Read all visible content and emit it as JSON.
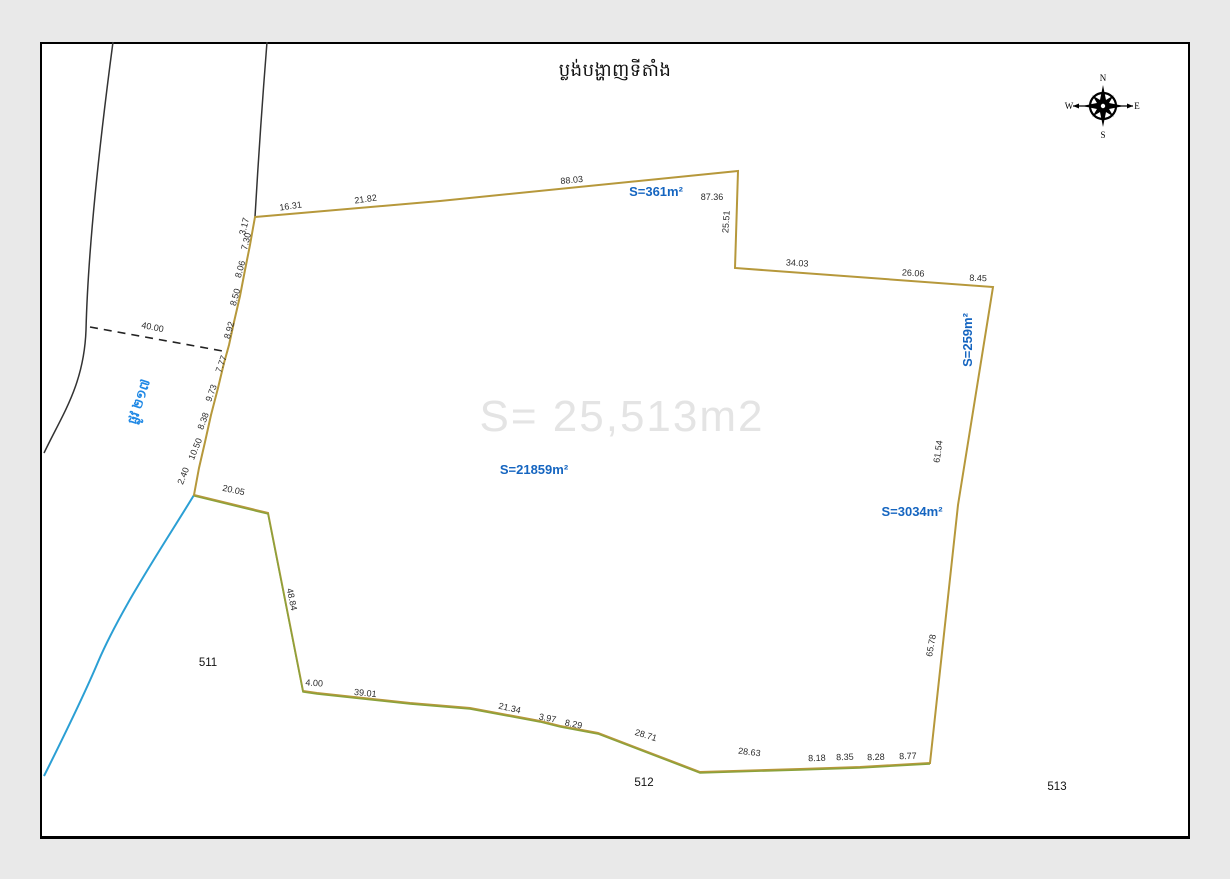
{
  "page": {
    "title": "ប្លង់បង្ហាញទីតាំង",
    "watermark": "S= 25,513m2"
  },
  "compass": {
    "north": "N",
    "south": "S",
    "east": "E",
    "west": "W"
  },
  "colors": {
    "boundary_gold": "#b6983b",
    "boundary_green": "#8aa23b",
    "river_blue": "#2b9fd4",
    "road_black": "#333333",
    "label_blue": "#1565c0",
    "watermark_gray": "#e4e4e4"
  },
  "road": {
    "name": "ផ្លូវ ២១៧",
    "x": 143,
    "y": 403,
    "rot": -72,
    "width_label": {
      "text": "40.00",
      "x": 152,
      "y": 330,
      "rot": 11
    }
  },
  "area_labels": [
    {
      "text": "S=361m²",
      "x": 656,
      "y": 196,
      "rot": 0
    },
    {
      "text": "S=259m²",
      "x": 972,
      "y": 340,
      "rot": -90
    },
    {
      "text": "S=21859m²",
      "x": 534,
      "y": 474,
      "rot": 0
    },
    {
      "text": "S=3034m²",
      "x": 912,
      "y": 516,
      "rot": 0
    }
  ],
  "parcel_labels": [
    {
      "text": "511",
      "x": 208,
      "y": 666
    },
    {
      "text": "512",
      "x": 644,
      "y": 786
    },
    {
      "text": "513",
      "x": 1057,
      "y": 790
    }
  ],
  "measurements": [
    {
      "text": "16.31",
      "x": 291,
      "y": 209,
      "rot": -8
    },
    {
      "text": "21.82",
      "x": 366,
      "y": 202,
      "rot": -8
    },
    {
      "text": "88.03",
      "x": 572,
      "y": 183,
      "rot": -6
    },
    {
      "text": "87.36",
      "x": 712,
      "y": 200,
      "rot": 0
    },
    {
      "text": "25.51",
      "x": 729,
      "y": 222,
      "rot": -86
    },
    {
      "text": "34.03",
      "x": 797,
      "y": 266,
      "rot": 3
    },
    {
      "text": "26.06",
      "x": 913,
      "y": 276,
      "rot": 3
    },
    {
      "text": "8.45",
      "x": 978,
      "y": 281,
      "rot": 2
    },
    {
      "text": "61.54",
      "x": 941,
      "y": 452,
      "rot": -82
    },
    {
      "text": "65.78",
      "x": 934,
      "y": 646,
      "rot": -80
    },
    {
      "text": "8.77",
      "x": 908,
      "y": 759,
      "rot": -2
    },
    {
      "text": "8.28",
      "x": 876,
      "y": 760,
      "rot": -2
    },
    {
      "text": "8.35",
      "x": 845,
      "y": 760,
      "rot": -2
    },
    {
      "text": "8.18",
      "x": 817,
      "y": 761,
      "rot": -2
    },
    {
      "text": "28.63",
      "x": 749,
      "y": 755,
      "rot": 7
    },
    {
      "text": "28.71",
      "x": 645,
      "y": 738,
      "rot": 17
    },
    {
      "text": "8.29",
      "x": 573,
      "y": 727,
      "rot": 11
    },
    {
      "text": "3.97",
      "x": 547,
      "y": 721,
      "rot": 11
    },
    {
      "text": "21.34",
      "x": 509,
      "y": 711,
      "rot": 13
    },
    {
      "text": "39.01",
      "x": 365,
      "y": 696,
      "rot": 6
    },
    {
      "text": "4.00",
      "x": 314,
      "y": 686,
      "rot": 4
    },
    {
      "text": "48.84",
      "x": 289,
      "y": 600,
      "rot": 78
    },
    {
      "text": "20.05",
      "x": 233,
      "y": 493,
      "rot": 12
    },
    {
      "text": "2.40",
      "x": 186,
      "y": 477,
      "rot": -68
    },
    {
      "text": "10.50",
      "x": 198,
      "y": 450,
      "rot": -68
    },
    {
      "text": "8.38",
      "x": 206,
      "y": 422,
      "rot": -70
    },
    {
      "text": "9.73",
      "x": 214,
      "y": 394,
      "rot": -70
    },
    {
      "text": "7.77",
      "x": 224,
      "y": 365,
      "rot": -70
    },
    {
      "text": "8.92",
      "x": 232,
      "y": 331,
      "rot": -74
    },
    {
      "text": "8.50",
      "x": 238,
      "y": 298,
      "rot": -74
    },
    {
      "text": "8.06",
      "x": 243,
      "y": 270,
      "rot": -74
    },
    {
      "text": "7.30",
      "x": 249,
      "y": 242,
      "rot": -76
    },
    {
      "text": "3.17",
      "x": 247,
      "y": 227,
      "rot": -76
    }
  ],
  "geometry": {
    "parcel_path": "M 255,217 L 440,201 L 738,171 L 735,268 L 993,287 L 958,505 L 930,763 L 860,767 L 800,769 L 700,772 L 598,733 L 560,726 L 540,721 L 470,708 L 410,703 L 317,693 L 303,691 L 268,513 L 194,495 L 199,468 L 205,442 L 211,415 L 218,388 L 224,363 L 229,345 L 234,322 L 240,296 L 245,270 L 250,245 L 253,228 Z",
    "green_path": "M 194,496 L 268,514 L 303,692 L 317,694 L 410,704 L 470,709 L 540,722 L 560,727 L 598,734 L 700,773 L 800,770 L 860,768 L 930,764",
    "road_line_1": "M 113,42 C 100,140 88,250 86,330 C 84,385 62,415 44,453",
    "road_line_2": "M 267,42 C 262,105 258,165 255,217",
    "river_path": "M 194,495 C 168,538 122,606 98,662 C 82,700 58,748 44,776",
    "dashed_line": "M 90,327 L 228,352"
  }
}
